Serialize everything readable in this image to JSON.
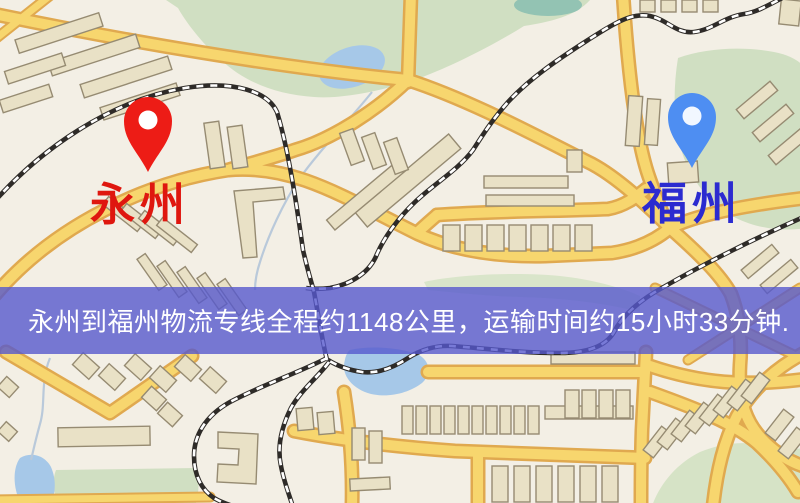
{
  "banner": {
    "text": "永州到福州物流专线全程约1148公里，运输时间约15小时33分钟.",
    "distance_text": "约1148公里",
    "duration_text": "约15小时33分钟",
    "background_color": "rgba(86,89,205,0.8)",
    "text_color": "#ffffff"
  },
  "origin": {
    "label": "永州",
    "label_color": "#df170f",
    "pin_color": "#ed1c16",
    "pin_icon": "map-pin"
  },
  "destination": {
    "label": "福州",
    "label_color": "#2b2bd0",
    "pin_color": "#4e8ef2",
    "pin_icon": "map-pin"
  },
  "map_colors": {
    "background": "#f3efe5",
    "park": "#d0dfc2",
    "water": "#a6c8e8",
    "road_fill": "#f7d66e",
    "road_casing": "#e0a94f",
    "railway": "#2e2b28",
    "building": "#e9e1c6"
  }
}
